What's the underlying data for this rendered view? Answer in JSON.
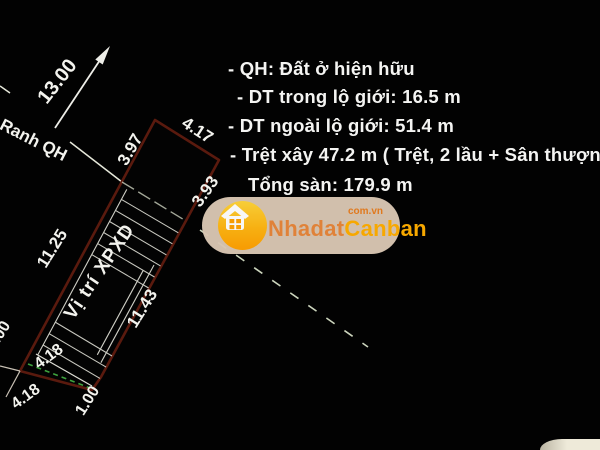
{
  "drawing": {
    "dim_offset": "13.00",
    "dim_top_left_edge": "3.97",
    "dim_top_edge": "4.17",
    "dim_right_upper_edge": "3.93",
    "dim_left_long_edge": "11.25",
    "dim_right_long_edge": "11.43",
    "dim_bottom_inner": "4.18",
    "dim_bottom_outer": "4.18",
    "dim_bottom_jog_right": "1.00",
    "dim_bottom_jog_left": "1.00",
    "boundary_label": "Ranh QH",
    "plot_label": "Vị trí XPXD"
  },
  "notes": {
    "line1": "- QH: Đất ở hiện hữu",
    "line2": "- DT trong lộ giới: 16.5 m",
    "line3": "- DT ngoài lộ giới: 51.4 m",
    "line4": "- Trệt xây 47.2 m ( Trệt, 2 lầu + Sân thượng)",
    "line5": "Tổng sàn: 179.9 m"
  },
  "watermark": {
    "brand_first": "Nhadat",
    "brand_second": "Canban",
    "suffix": "com.vn",
    "icon": "house-icon"
  },
  "colors": {
    "background": "#020202",
    "plot_outline_maroon": "#5a1a0e",
    "line_white": "#e8e8e0",
    "boundary_dash_green": "#3da23d",
    "pill_beige": "#d8c6b2",
    "brand_orange": "#e8873b",
    "brand_gold": "#ffae00"
  }
}
